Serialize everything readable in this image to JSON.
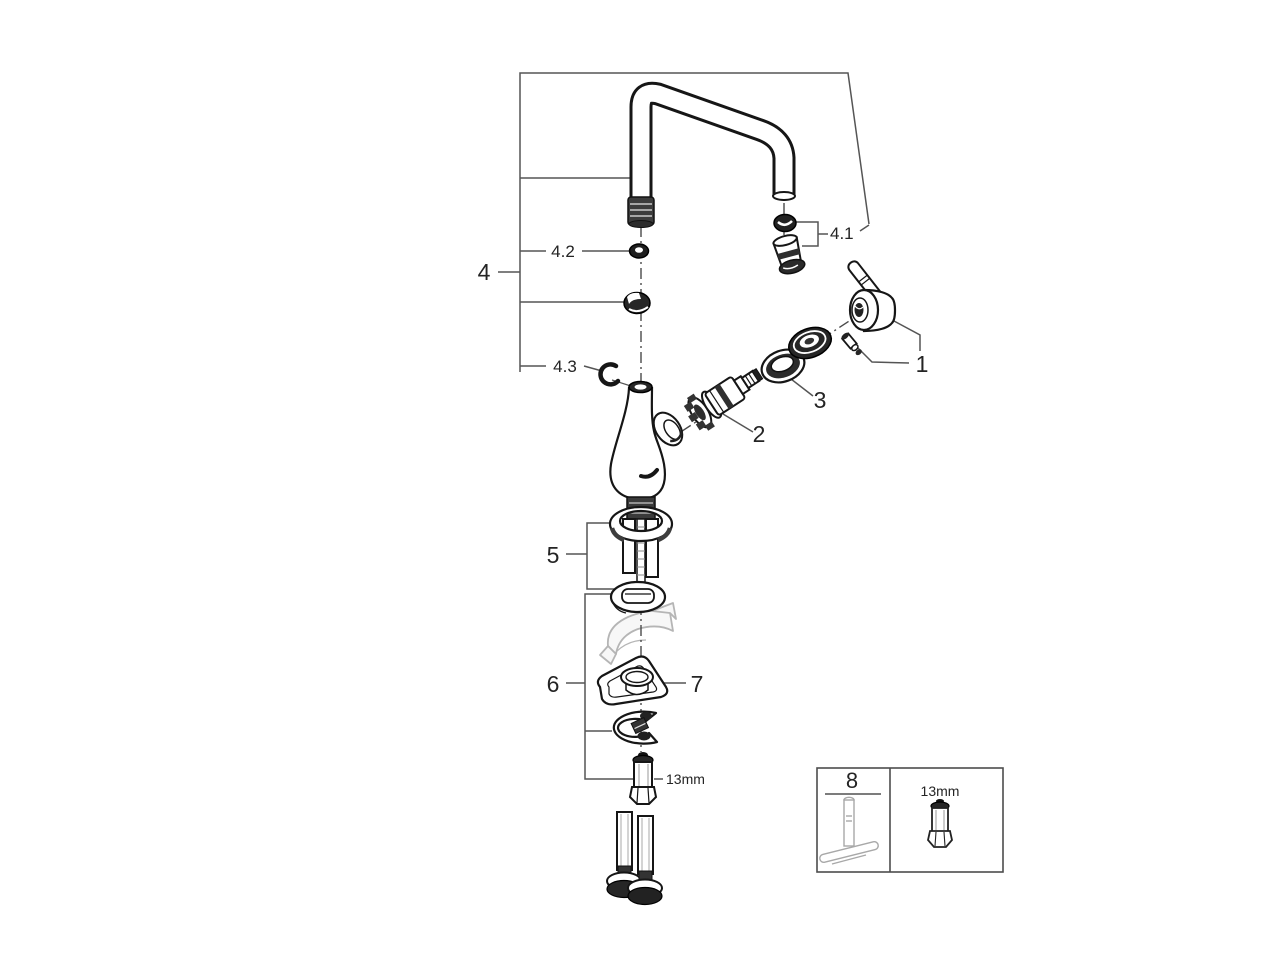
{
  "page": {
    "background": "#ffffff"
  },
  "diagram": {
    "colors": {
      "ink": "#1a1a1a",
      "callout_line": "#555555",
      "ghost": "#b5b5b5",
      "background": "#ffffff"
    },
    "callouts": {
      "n1": "1",
      "n2": "2",
      "n3": "3",
      "n4": "4",
      "n41": "4.1",
      "n42": "4.2",
      "n43": "4.3",
      "n5": "5",
      "n6": "6",
      "n7": "7",
      "size_label": "13mm"
    },
    "inset": {
      "n8": "8",
      "size_label": "13mm"
    }
  }
}
